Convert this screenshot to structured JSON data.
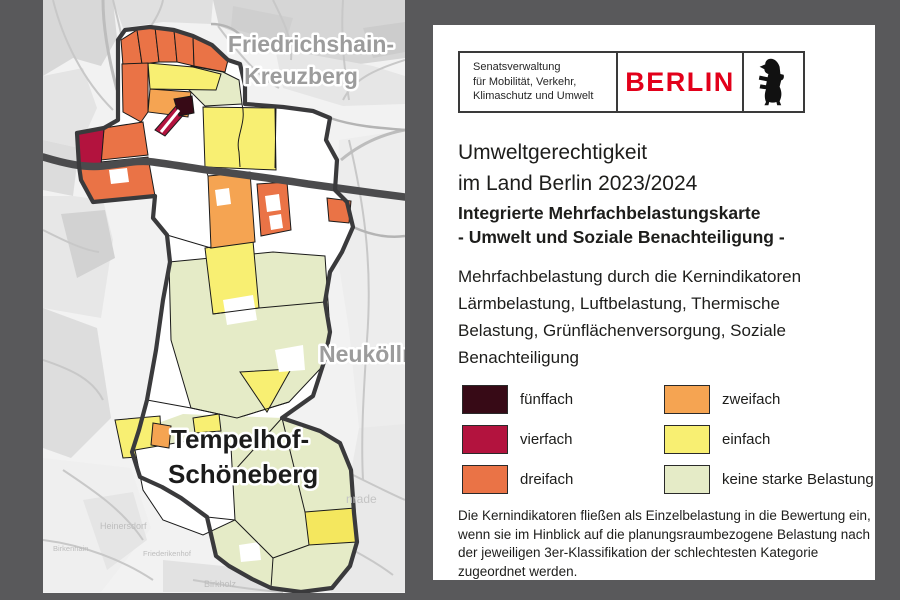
{
  "background_color": "#59595b",
  "panel": {
    "logo": {
      "agency_lines": [
        "Senatsverwaltung",
        "für Mobilität, Verkehr,",
        "Klimaschutz und Umwelt"
      ],
      "brand": "BERLIN",
      "brand_color": "#e2001a",
      "bear_icon": "berlin-bear"
    },
    "title_lines": [
      "Umweltgerechtigkeit",
      "im Land Berlin 2023/2024"
    ],
    "subtitle_lines": [
      "Integrierte Mehrfachbelastungskarte",
      "- Umwelt und Soziale Benachteiligung -"
    ],
    "description_lines": [
      "Mehrfachbelastung durch die Kernindikatoren",
      "Lärmbelastung, Luftbelastung, Thermische",
      "Belastung, Grünflächenversorgung, Soziale",
      "Benachteiligung"
    ],
    "legend": {
      "items": [
        {
          "label": "fünffach",
          "color": "#370a16"
        },
        {
          "label": "vierfach",
          "color": "#b3133e"
        },
        {
          "label": "dreifach",
          "color": "#ea7346"
        },
        {
          "label": "zweifach",
          "color": "#f5a452"
        },
        {
          "label": "einfach",
          "color": "#f8ef72"
        },
        {
          "label": "keine starke Belastung",
          "color": "#e5ebc7"
        }
      ]
    },
    "footnote_lines": [
      "Die Kernindikatoren fließen als Einzelbelastung in die Bewertung ein,",
      "wenn sie im Hinblick auf die planungsraumbezogene Belastung nach",
      "der jeweiligen 3er-Klassifikation der schlechtesten Kategorie",
      "zugeordnet werden."
    ]
  },
  "map": {
    "district_labels": {
      "friedrichshain_line1": "Friedrichshain-",
      "friedrichshain_line2": "Kreuzberg",
      "neukoelln": "Neukölln",
      "tempelhof_line1": "Tempelhof-",
      "tempelhof_line2": "Schöneberg"
    },
    "minor_labels": [
      "Heinersdorf",
      "Birkenhain",
      "Friederikenhof",
      "Birkholz",
      "nrade"
    ]
  }
}
